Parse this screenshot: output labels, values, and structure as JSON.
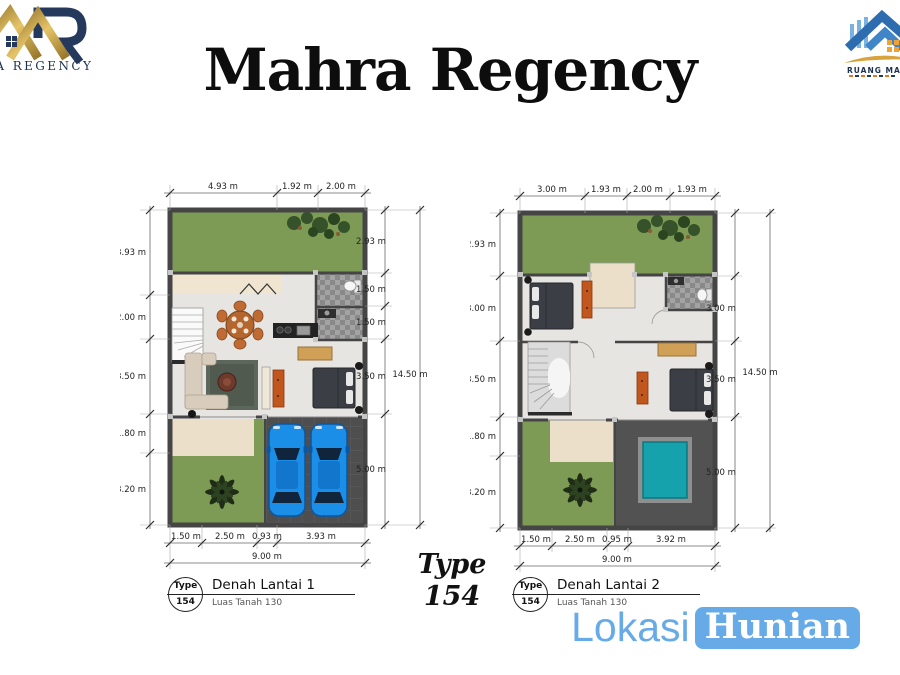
{
  "header": {
    "title": "Mahra Regency"
  },
  "logo_left": {
    "text": "RA REGENCY"
  },
  "logo_right": {
    "text": "RUANG MA"
  },
  "type_label": {
    "line1": "Type",
    "line2": "154"
  },
  "watermark": {
    "part1": "Lokasi",
    "part2": "Hunian",
    "color": "#66abe8"
  },
  "plan1": {
    "top_dims": [
      "4.93 m",
      "1.92 m",
      "2.00 m"
    ],
    "left_dims": [
      "3.93 m",
      "2.00 m",
      "3.50 m",
      "1.80 m",
      "3.20 m"
    ],
    "right_dims": [
      "2.93 m",
      "1.50 m",
      "1.50 m",
      "3.50 m",
      "5.00 m"
    ],
    "right_total": "14.50 m",
    "bottom_dims": [
      "1.50 m",
      "2.50 m",
      "0.93 m",
      "3.93 m"
    ],
    "bottom_total": "9.00 m",
    "badge": {
      "type_word": "Type",
      "type_num": "154",
      "title": "Denah Lantai 1",
      "subtitle": "Luas Tanah 130"
    }
  },
  "plan2": {
    "top_dims": [
      "3.00 m",
      "1.93 m",
      "2.00 m",
      "1.93 m"
    ],
    "left_dims": [
      "2.93 m",
      "3.00 m",
      "3.50 m",
      "1.80 m",
      "3.20 m"
    ],
    "right_dims": [
      "3.00 m",
      "3.50 m",
      "5.00 m"
    ],
    "right_total": "14.50 m",
    "bottom_dims": [
      "1.50 m",
      "2.50 m",
      "0.95 m",
      "3.92 m"
    ],
    "bottom_total": "9.00 m",
    "badge": {
      "type_word": "Type",
      "type_num": "154",
      "title": "Denah Lantai 2",
      "subtitle": "Luas Tanah 130"
    }
  }
}
